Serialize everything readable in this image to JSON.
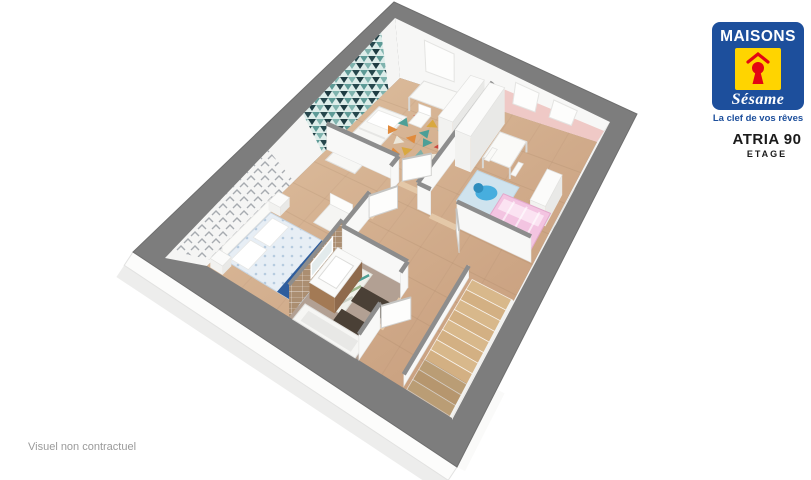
{
  "brand": {
    "name_top": "MAISONS",
    "name_script": "Sésame",
    "tagline": "La clef de vos rêves",
    "colors": {
      "blue": "#1d4f9c",
      "yellow": "#ffd400",
      "red": "#e30613"
    }
  },
  "plan": {
    "model": "ATRIA 90",
    "level": "ETAGE"
  },
  "footer": {
    "disclaimer": "Visuel non contractuel"
  },
  "scene": {
    "wall_gray": "#7d7d7d",
    "floor_wood": "#d2ab89",
    "accent_teal": "#2b555c",
    "accent_pink": "#efc9c6",
    "bathroom_floor": "#b2a093",
    "stairs_wood": "#d8b88b",
    "kids_bed_pink": "#f3c4e1",
    "runner_blue": "#2e5d9d",
    "toy_blue": "#47aede"
  }
}
